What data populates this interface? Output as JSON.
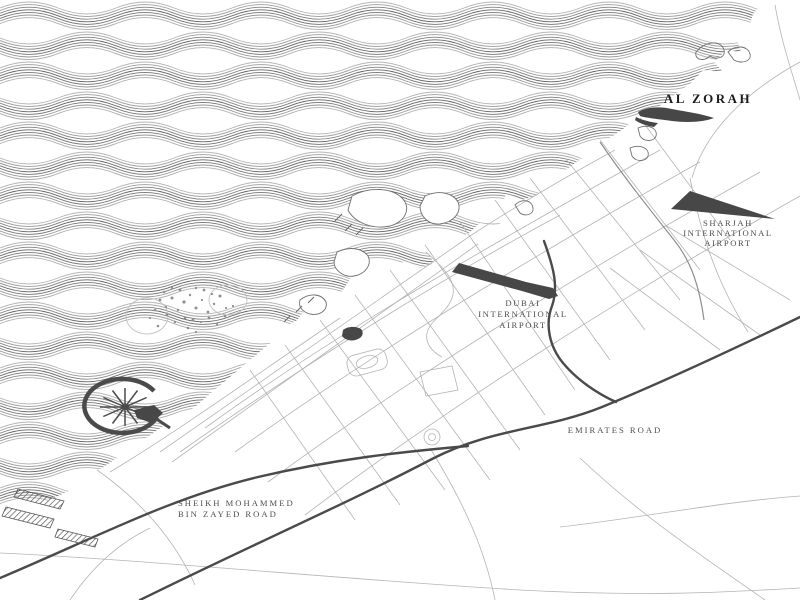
{
  "map": {
    "labels": {
      "al_zorah": "AL ZORAH",
      "sharjah_airport": [
        "SHARJAH",
        "INTERNATIONAL",
        "AIRPORT"
      ],
      "dubai_airport": [
        "DUBAI",
        "INTERNATIONAL",
        "AIRPORT"
      ],
      "emirates_road": "EMIRATES ROAD",
      "smbz_road": [
        "SHEIKH MOHAMMED",
        "BIN ZAYED ROAD"
      ]
    },
    "colors": {
      "sea_wave": "#5e5e5e",
      "land": "#ffffff",
      "dark_feature": "#474747",
      "road_major": "#4a4a4a",
      "road_minor": "#b4b4b4",
      "label_dark": "#1c1c1c",
      "label_gray": "#4e4e4e"
    }
  }
}
